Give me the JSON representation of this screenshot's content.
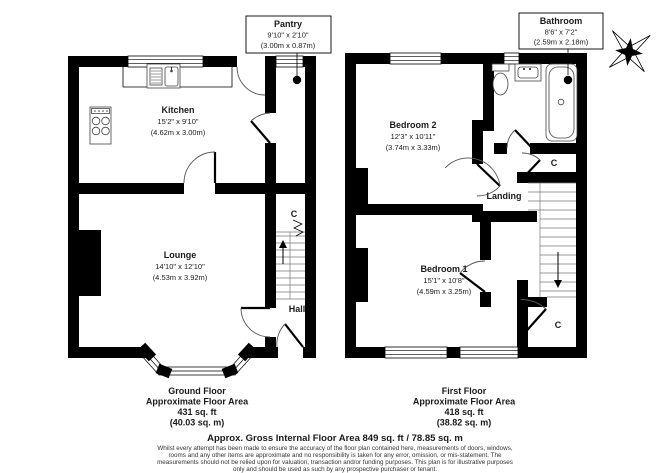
{
  "ground_floor": {
    "kitchen": {
      "name": "Kitchen",
      "imperial": "15'2\" x 9'10\"",
      "metric": "(4.62m x 3.00m)"
    },
    "lounge": {
      "name": "Lounge",
      "imperial": "14'10\" x 12'10\"",
      "metric": "(4.53m x 3.92m)"
    },
    "pantry": {
      "name": "Pantry",
      "imperial": "9'10\" x 2'10\"",
      "metric": "(3.00m x 0.87m)"
    },
    "hall": {
      "name": "Hall"
    },
    "cupboard": {
      "name": "C"
    },
    "summary": {
      "title": "Ground Floor",
      "line1": "Approximate Floor Area",
      "line2": "431 sq. ft",
      "line3": "(40.03 sq. m)"
    }
  },
  "first_floor": {
    "bedroom2": {
      "name": "Bedroom 2",
      "imperial": "12'3\" x 10'11\"",
      "metric": "(3.74m x 3.33m)"
    },
    "bedroom1": {
      "name": "Bedroom 1",
      "imperial": "15'1\" x 10'8\"",
      "metric": "(4.59m x 3.25m)"
    },
    "bathroom": {
      "name": "Bathroom",
      "imperial": "8'6\" x 7'2\"",
      "metric": "(2.59m x 2.18m)"
    },
    "landing": {
      "name": "Landing"
    },
    "cupboard_top": {
      "name": "C"
    },
    "cupboard_bottom": {
      "name": "C"
    },
    "summary": {
      "title": "First Floor",
      "line1": "Approximate Floor Area",
      "line2": "418 sq. ft",
      "line3": "(38.82 sq. m)"
    }
  },
  "footer": {
    "title": "Approx. Gross Internal Floor Area 849 sq. ft / 78.85 sq. m",
    "disclaimer": [
      "Whilst every attempt has been made to ensure the accuracy of the floor plan contained here, measurements of doors, windows,",
      "rooms and any other items are approximate and no responsibility is taken for any error, omission, or mis-statement. The",
      "measurements should not be relied upon for valuation, transaction and/or funding purposes. This plan is for illustrative purposes",
      "only and should be used as such by any prospective purchaser or tenant."
    ]
  }
}
